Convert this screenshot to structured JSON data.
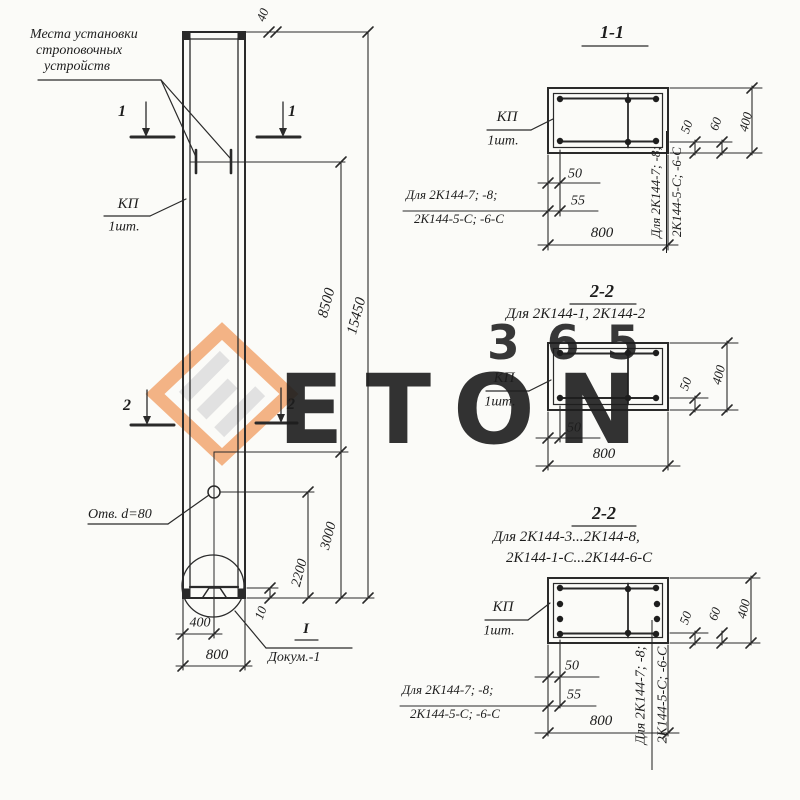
{
  "watermark": {
    "number": "365",
    "letters": "ETON",
    "orange": "#f2a469",
    "gray": "#dbdbdb"
  },
  "note": {
    "line1": "Места установки",
    "line2": "строповочных",
    "line3": "устройств"
  },
  "column_label": {
    "name": "КП",
    "qty": "1шт."
  },
  "markers": {
    "s1": "1",
    "s2": "2"
  },
  "elevation_dims": {
    "top_40": "40",
    "upper_8500": "8500",
    "total_15450": "15450",
    "lower_3000": "3000",
    "hole_2200": "2200",
    "toe_10": "10",
    "half_400": "400",
    "width_800": "800"
  },
  "hole": {
    "label": "Отв. d=80"
  },
  "detail": {
    "mark": "I",
    "doc": "Докум.-1"
  },
  "alt_note": {
    "line1": "Для 2К144-7; -8;",
    "line2": "2К144-5-С; -6-С"
  },
  "sections": {
    "s1": {
      "title": "1-1",
      "label": "КП",
      "qty": "1шт.",
      "dim_50b": "50",
      "dim_55": "55",
      "dim_800": "800",
      "dim_50r": "50",
      "dim_60": "60",
      "dim_400": "400"
    },
    "s2": {
      "title": "2-2",
      "subtitle": "Для 2К144-1, 2К144-2",
      "label": "КП",
      "qty": "1шт.",
      "dim_50b": "50",
      "dim_800": "800",
      "dim_50r": "50",
      "dim_400": "400"
    },
    "s3": {
      "title": "2-2",
      "subtitle1": "Для 2К144-3...2К144-8,",
      "subtitle2": "2К144-1-С...2К144-6-С",
      "label": "КП",
      "qty": "1шт.",
      "dim_50b": "50",
      "dim_55": "55",
      "dim_800": "800",
      "dim_50r": "50",
      "dim_60": "60",
      "dim_400": "400"
    }
  }
}
